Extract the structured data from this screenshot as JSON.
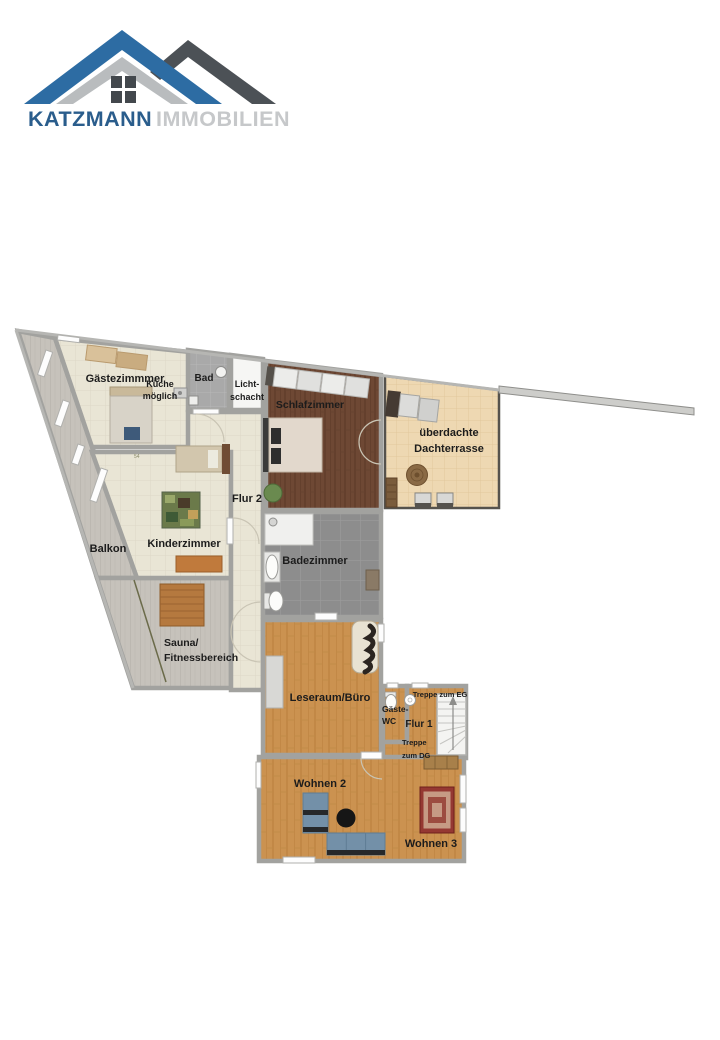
{
  "page": {
    "type": "real-estate floor plan image",
    "background": "#ffffff"
  },
  "logo": {
    "brand_primary": "KATZMANN",
    "brand_secondary": "IMMOBILIEN",
    "icon": "house-roofs-icon",
    "colors": {
      "roof_blue": "#2d6ca3",
      "roof_silver": "#b9bcbe",
      "roof_dark": "#4c5156",
      "text_blue": "#2a5d8c",
      "text_gray": "#c6c8ca"
    }
  },
  "floorplan": {
    "rooms": {
      "gaestezimmer": {
        "label": "Gästezimmmer"
      },
      "kueche": {
        "line1": "Küche",
        "line2": "möglich"
      },
      "bad": {
        "label": "Bad"
      },
      "lichtschacht": {
        "line1": "Licht-",
        "line2": "schacht"
      },
      "schlafzimmer": {
        "label": "Schlafzimmer"
      },
      "dachterrasse": {
        "line1": "überdachte",
        "line2": "Dachterrasse"
      },
      "flur2": {
        "label": "Flur 2"
      },
      "kinderzimmer": {
        "label": "Kinderzimmer"
      },
      "balkon": {
        "label": "Balkon"
      },
      "badezimmer": {
        "label": "Badezimmer"
      },
      "sauna": {
        "line1": "Sauna/",
        "line2": "Fitnessbereich"
      },
      "leseraum": {
        "label": "Leseraum/Büro"
      },
      "gaeste_wc": {
        "line1": "Gäste-",
        "line2": "WC"
      },
      "flur1": {
        "label": "Flur 1"
      },
      "wohnen2": {
        "label": "Wohnen 2"
      },
      "wohnen3": {
        "label": "Wohnen 3"
      }
    },
    "annotations": {
      "treppe_eg": "Treppe zum EG",
      "treppe_dg_line1": "Treppe",
      "treppe_dg_line2": "zum DG",
      "floor_mark": "54"
    },
    "colors": {
      "wall": "#a2a29f",
      "floor_beige": "#e9e5d5",
      "floor_gray_planks": "#c6c2bb",
      "floor_oak": "#cb9250",
      "floor_dark_wood": "#6e4834",
      "floor_bath_tile": "#8d8d8d",
      "terrace_floor": "#eed8b2",
      "sofa_blue": "#7390a8",
      "rug_red": "#953832"
    }
  }
}
